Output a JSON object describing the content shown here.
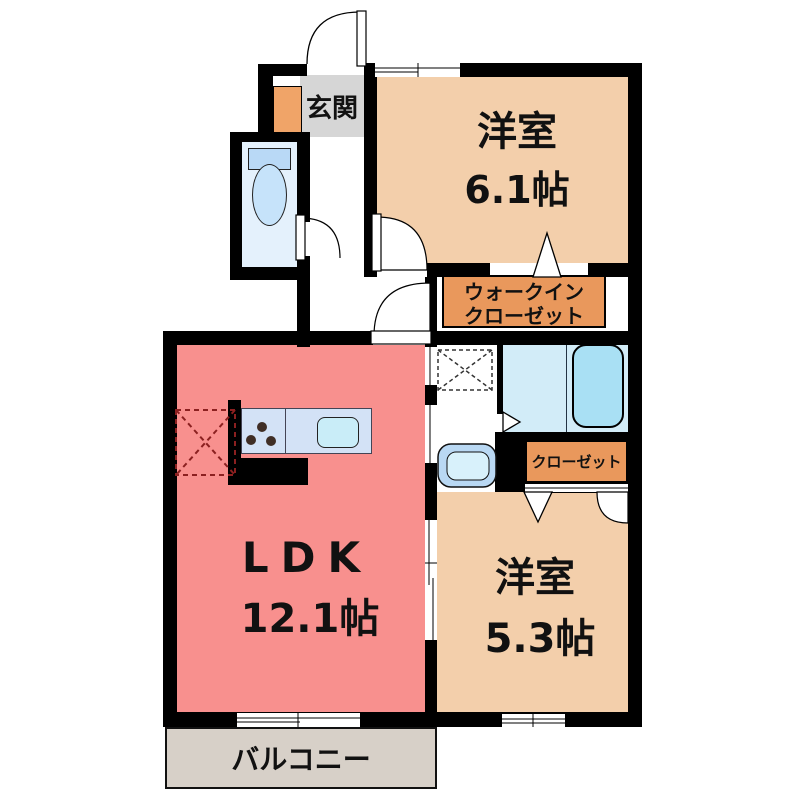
{
  "plan_title": "1LDK apartment floor plan",
  "rooms": {
    "genkan": {
      "label": "玄関"
    },
    "bedroom1": {
      "name": "洋室",
      "size": "6.1帖"
    },
    "wic": {
      "line1": "ウォークイン",
      "line2": "クローゼット"
    },
    "closet": {
      "label": "クローゼット"
    },
    "ldk": {
      "name": "LDK",
      "size": "12.1帖"
    },
    "bedroom2": {
      "name": "洋室",
      "size": "5.3帖"
    },
    "balcony": {
      "label": "バルコニー"
    }
  },
  "fixtures": {
    "toilet": "toilet",
    "bathtub": "bathtub",
    "washbasin": "washbasin",
    "washer_pad": "washing-machine-space",
    "fridge_pad": "refrigerator-space",
    "stove_burners": 3
  },
  "colors": {
    "wall": "#000000",
    "ldk_floor": "#f8908e",
    "bedroom_floor": "#f3cfab",
    "label_box": "#e9985c",
    "shoe_cabinet": "#f0a468",
    "genkan_floor": "#d6d6d6",
    "toilet_floor": "#e4f1fc",
    "bath_floor": "#d2ecf8",
    "bathtub": "#a9e0f4",
    "counter": "#d3e2f6",
    "sink": "#c9edf8",
    "balcony_floor": "#d7d0c8"
  }
}
